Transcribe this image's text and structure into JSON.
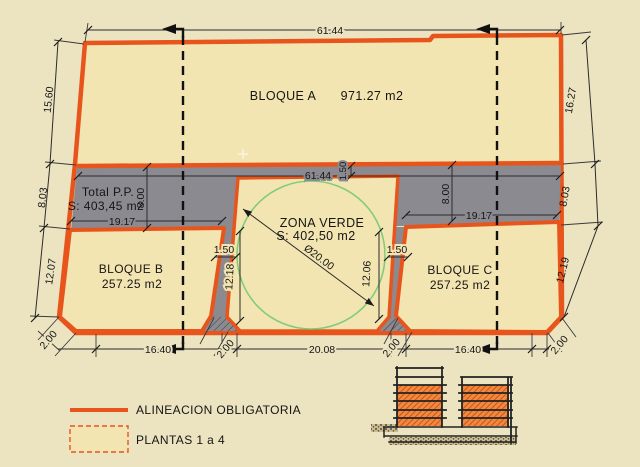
{
  "colors": {
    "background": "#ece3c1",
    "parcel_fill": "#f3e5b2",
    "alignment_orange": "#e8551c",
    "reserved_gray": "#8b8a90",
    "green_circle": "#82cc78",
    "hatch_orange": "#f08a3e"
  },
  "blocks": {
    "a": {
      "label": "BLOQUE A",
      "area": "971.27 m2"
    },
    "b": {
      "label": "BLOQUE B",
      "area": "257.25 m2"
    },
    "c": {
      "label": "BLOQUE C",
      "area": "257.25 m2"
    },
    "pp": {
      "label": "Total P.P.",
      "area": "S: 403,45 m2"
    },
    "verde": {
      "label": "ZONA VERDE",
      "area": "S: 402,50 m2",
      "diameter": "Ø20.00"
    }
  },
  "dims": {
    "top_width": "61.44",
    "inner_width": "61.44",
    "left_a": "15.60",
    "left_pp": "8.03",
    "left_b": "12.07",
    "right_a": "16.27",
    "right_pp": "8.03",
    "right_c": "12.19",
    "pp_h_left": "8.00",
    "pp_h_right": "8.00",
    "pp_w_left": "19.17",
    "pp_w_right": "19.17",
    "verde_setback": "1.50",
    "gap_left": "1.50",
    "gap_right": "1.50",
    "verde_h_left": "12.18",
    "verde_h_right": "12.06",
    "bottom_b": "16.40",
    "bottom_verde": "20.08",
    "bottom_c": "16.40",
    "chamfer_bl": "2.00",
    "chamfer_ml": "2.00",
    "chamfer_mr": "2.00",
    "chamfer_br": "2.00"
  },
  "legend": {
    "alignment": "ALINEACION OBLIGATORIA",
    "floors": "PLANTAS  1 a 4"
  }
}
